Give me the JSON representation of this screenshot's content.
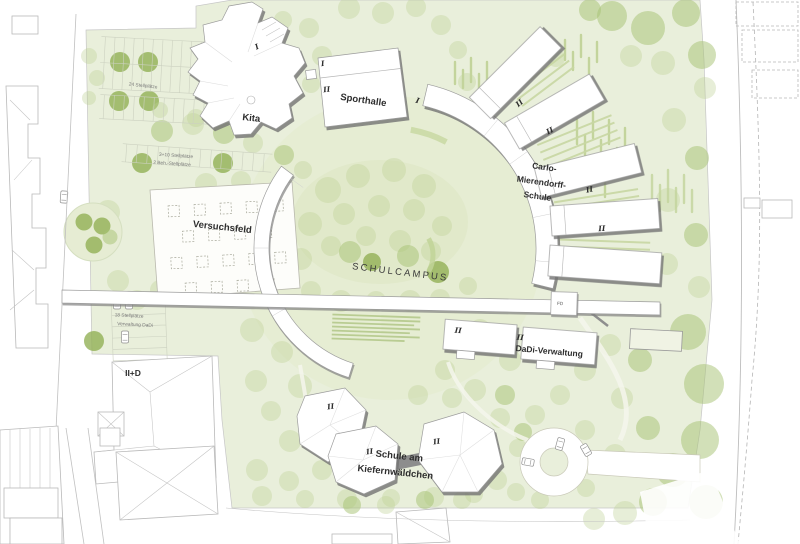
{
  "plan": {
    "campus_label": "SCHULCAMPUS",
    "buildings": {
      "kita": {
        "name": "Kita",
        "storeys": "I"
      },
      "sporthalle": {
        "name": "Sporthalle",
        "storeys_hall": "I",
        "storeys_main": "II"
      },
      "carlo_schule": {
        "name_line1": "Carlo-",
        "name_line2": "Mierendorff-",
        "name_line3": "Schule",
        "ring_mark": "I",
        "wing_storeys": "II"
      },
      "dadi_verwaltung": {
        "name": "DaDi-Verwaltung",
        "storeys": "II",
        "flat_roof_mark": "FD"
      },
      "kiefernwaeldchen": {
        "name_line1": "Schule am",
        "name_line2": "Kiefernwäldchen",
        "storeys": "II"
      },
      "bestand": {
        "storeys": "II+D"
      }
    },
    "open_spaces": {
      "versuchsfeld": {
        "name": "Versuchsfeld"
      }
    },
    "parking": {
      "north": "24 Stellplätze",
      "west_line1": "3+10 Stellplätze",
      "west_line2": "2 Beh.-Stellplätze",
      "southwest_line1": "18 Stellplätze",
      "southwest_line2": "Verwaltung DaDi"
    },
    "colors": {
      "site_green": "#e9efdb",
      "campus_green": "#dbe5c1",
      "tree_green": "#8fae52",
      "building_fill": "#ffffff",
      "shadow_gray": "#8c8c8c",
      "context_outline": "#b9b9b9",
      "label_dark": "#2d2d2d",
      "label_muted": "#787878"
    }
  }
}
